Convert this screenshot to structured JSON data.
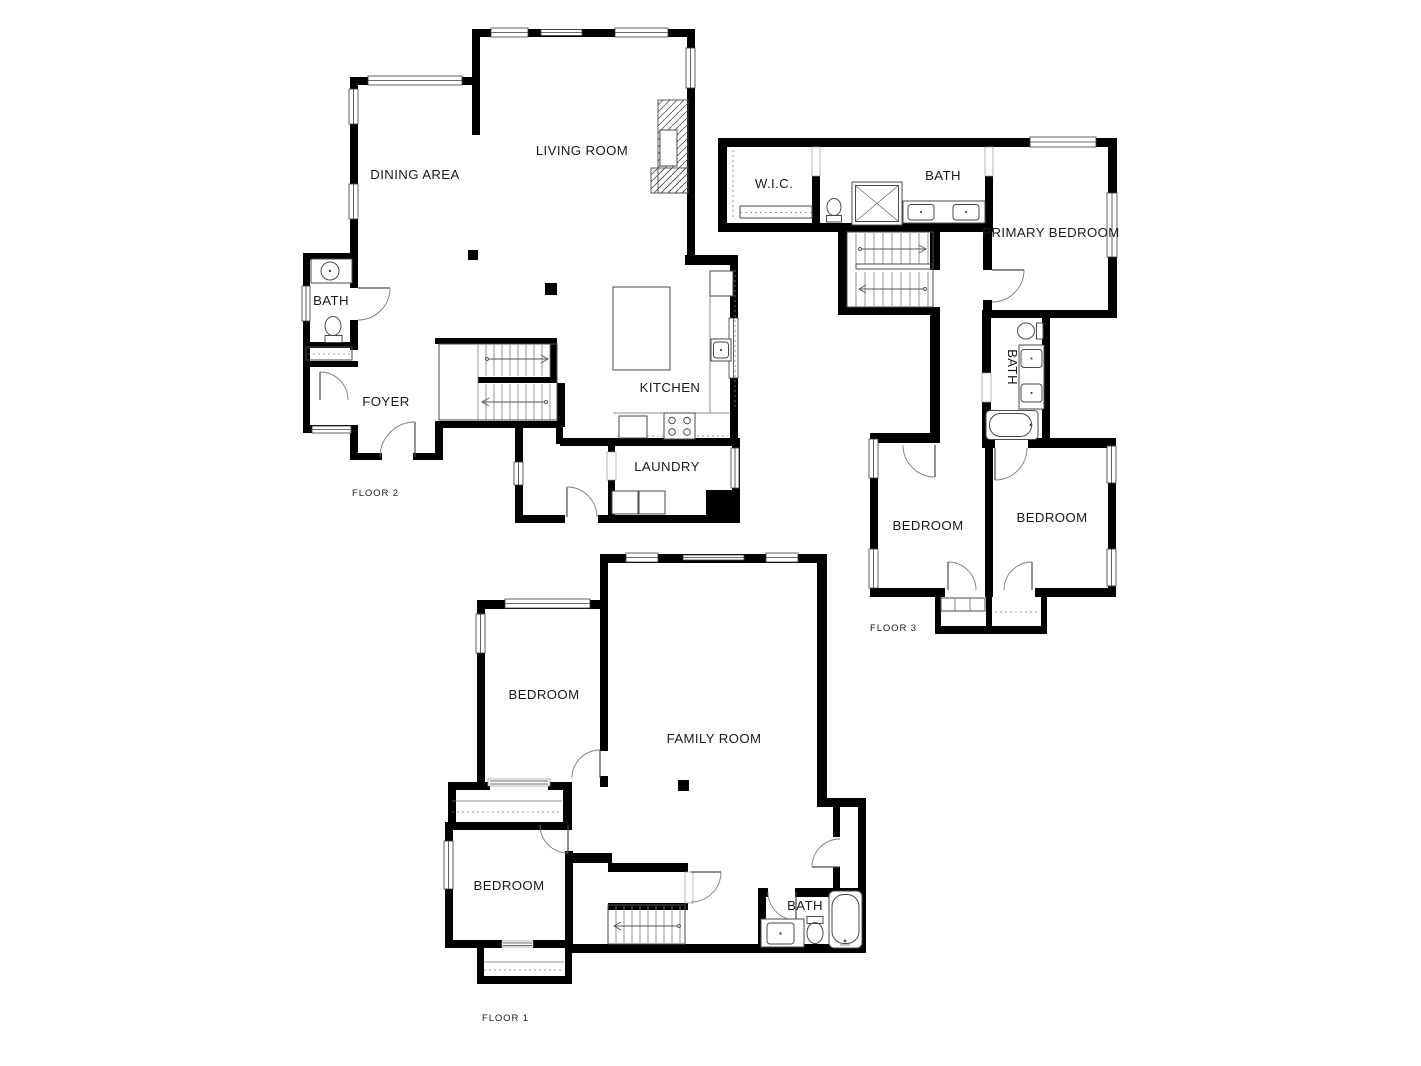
{
  "title": "Three-floor house floor plan",
  "colors": {
    "wall": "#000000",
    "line": "#4a4a4a",
    "text": "#1a1a1a",
    "background": "#ffffff"
  },
  "floors": {
    "floor_1": {
      "label": "FLOOR 1",
      "rooms": {
        "bedroom_upper": "BEDROOM",
        "family_room": "FAMILY ROOM",
        "bedroom_lower": "BEDROOM",
        "bath": "BATH"
      }
    },
    "floor_2": {
      "label": "FLOOR 2",
      "rooms": {
        "dining_area": "DINING AREA",
        "living_room": "LIVING ROOM",
        "bath": "BATH",
        "foyer": "FOYER",
        "kitchen": "KITCHEN",
        "laundry": "LAUNDRY"
      }
    },
    "floor_3": {
      "label": "FLOOR 3",
      "rooms": {
        "wic": "W.I.C.",
        "bath_upper": "BATH",
        "primary_bedroom": "PRIMARY BEDROOM",
        "bath_hall": "BATH",
        "bedroom_west": "BEDROOM",
        "bedroom_east": "BEDROOM"
      }
    }
  }
}
